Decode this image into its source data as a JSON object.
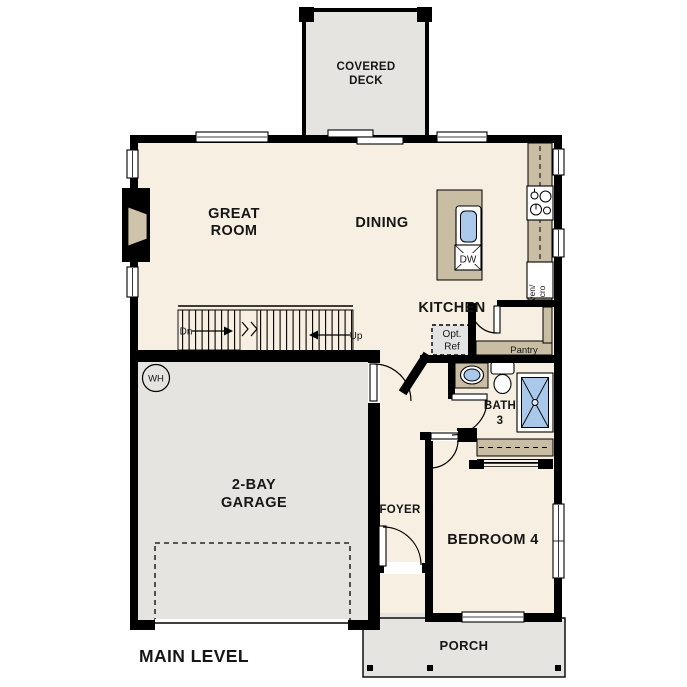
{
  "plan": {
    "title": "MAIN LEVEL",
    "labels": {
      "covered_deck_1": "COVERED",
      "covered_deck_2": "DECK",
      "great_room_1": "GREAT",
      "great_room_2": "ROOM",
      "dining": "DINING",
      "kitchen": "KITCHEN",
      "pantry": "Pantry",
      "opt_ref_1": "Opt.",
      "opt_ref_2": "Ref",
      "oven_micro_1": "Oven/",
      "oven_micro_2": "Micro",
      "dishwasher": "DW",
      "water_heater": "WH",
      "stairs_down": "Dn",
      "stairs_up": "Up",
      "garage_1": "2-BAY",
      "garage_2": "GARAGE",
      "foyer": "FOYER",
      "bedroom4": "BEDROOM 4",
      "bath3_1": "BATH",
      "bath3_2": "3",
      "porch": "PORCH"
    },
    "colors": {
      "wall": "#000000",
      "floor_interior": "#f7efe1",
      "floor_concrete": "#e5e4e0",
      "cabinet_tan": "#c9bda3",
      "fixture_blue": "#a9c8ea"
    }
  }
}
